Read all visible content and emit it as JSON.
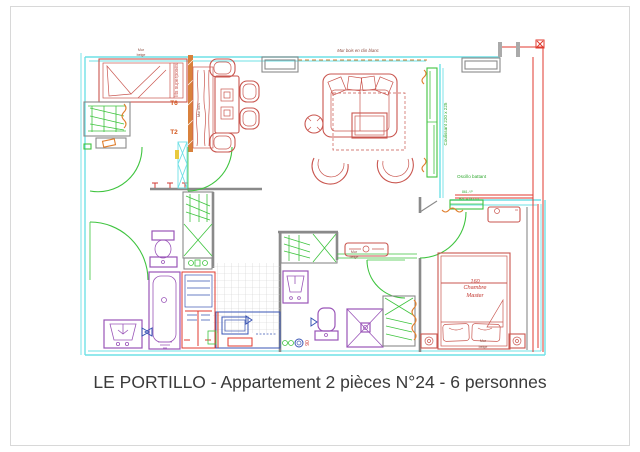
{
  "page": {
    "caption": "LE PORTILLO - Appartement 2 pièces N°24 - 6 personnes"
  },
  "labels": {
    "mur_beige_top": {
      "l1": "Mur",
      "l2": "beige"
    },
    "lits_superposes": "lits superposés",
    "door_t6": "T6",
    "door_t2": "T2",
    "mur_bois_strip": "Mur bois",
    "mur_bois_clin": "Mur bois en clin blanc",
    "coulissant": "Coulissant 220 x 225",
    "oscillo": {
      "title": "Oscillo battant",
      "dim1": "861 / P",
      "dim2": "BZL 4 DU / d"
    },
    "radiator_wall": {
      "l1": "Mur",
      "l2": "beige"
    },
    "bedroom": {
      "bed_size": "160",
      "room_l1": "Chambre",
      "room_l2": "Master"
    },
    "bed_wall": {
      "l1": "Mur",
      "l2": "beige"
    },
    "kitchen_dim": "90"
  },
  "colors": {
    "wall_cyan": "#6fe0e6",
    "furniture_red": "#c9564f",
    "accent_red": "#e03a2f",
    "door_green": "#3fc43f",
    "text_green": "#2fa82f",
    "fixture_purple": "#9a55b8",
    "appliance_blue": "#3a55b4",
    "radiator_orange": "#e07f2e",
    "wall_gray": "#8a8a8a",
    "label_maroon": "#8b4a3e",
    "caption_dark": "#3a3a3a"
  }
}
